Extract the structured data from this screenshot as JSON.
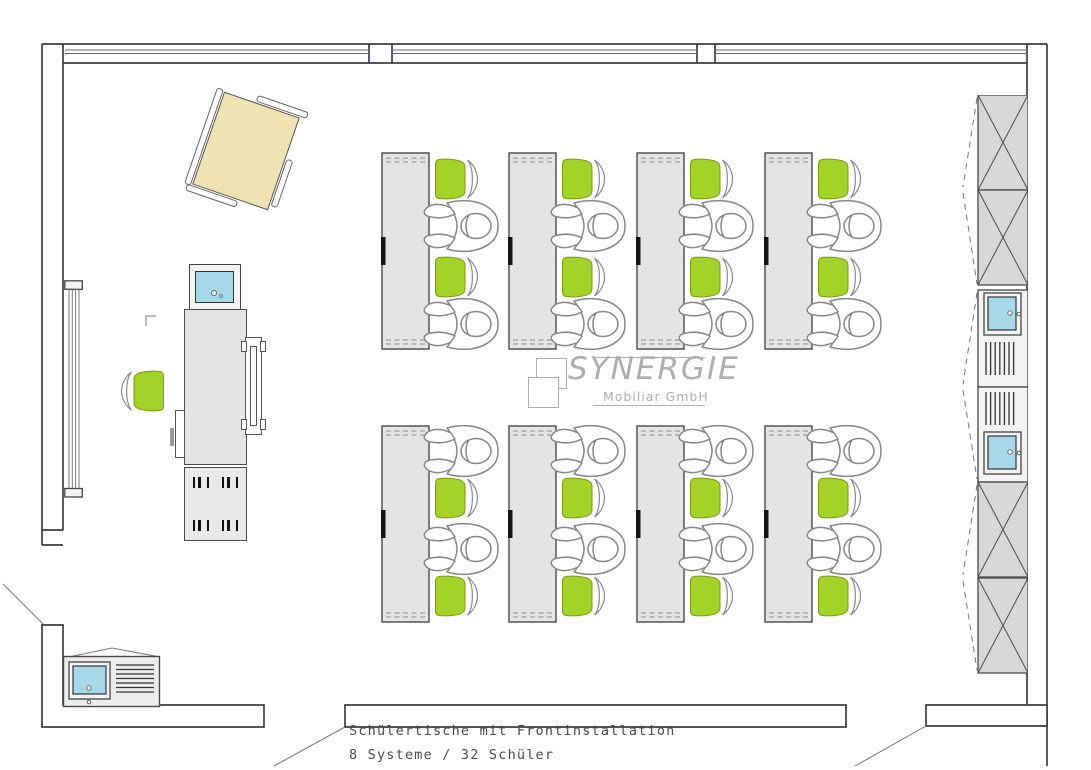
{
  "caption": {
    "line1": "Schülertische mit Frontinstallation",
    "line2": "8 Systeme / 32 Schüler"
  },
  "logo": {
    "name": "SYNERGIE",
    "subtitle": "Mobiliar GmbH"
  },
  "plan": {
    "student_desk_groups": 8,
    "desks_per_row": 4,
    "rows": 2,
    "seats_per_desk": 4,
    "systems_total": 8,
    "students_total": 32,
    "furniture": [
      "mobile-presentation-board",
      "teacher-desk-with-monitor",
      "teacher-chair",
      "teacher-side-rail",
      "teacher-cabinet",
      "wall-radiator",
      "student-desk-with-front-installation",
      "green-student-chair",
      "seated-student-figure",
      "storage-cabinet-with-doors",
      "pc-cabinet-with-monitor-and-vents",
      "printer-station-with-monitor"
    ]
  },
  "colors": {
    "chair_green": "#a3d329",
    "desk_gray": "#e4e4e4",
    "screen_blue": "#a5d8e8",
    "board_beige": "#efe3b4",
    "cabinet_gray": "#d8d8d8",
    "line_dark": "#3d3d44",
    "line_gray": "#8a8a8a",
    "text_gray": "#4a4a4a",
    "logo_gray": "#adadad"
  }
}
